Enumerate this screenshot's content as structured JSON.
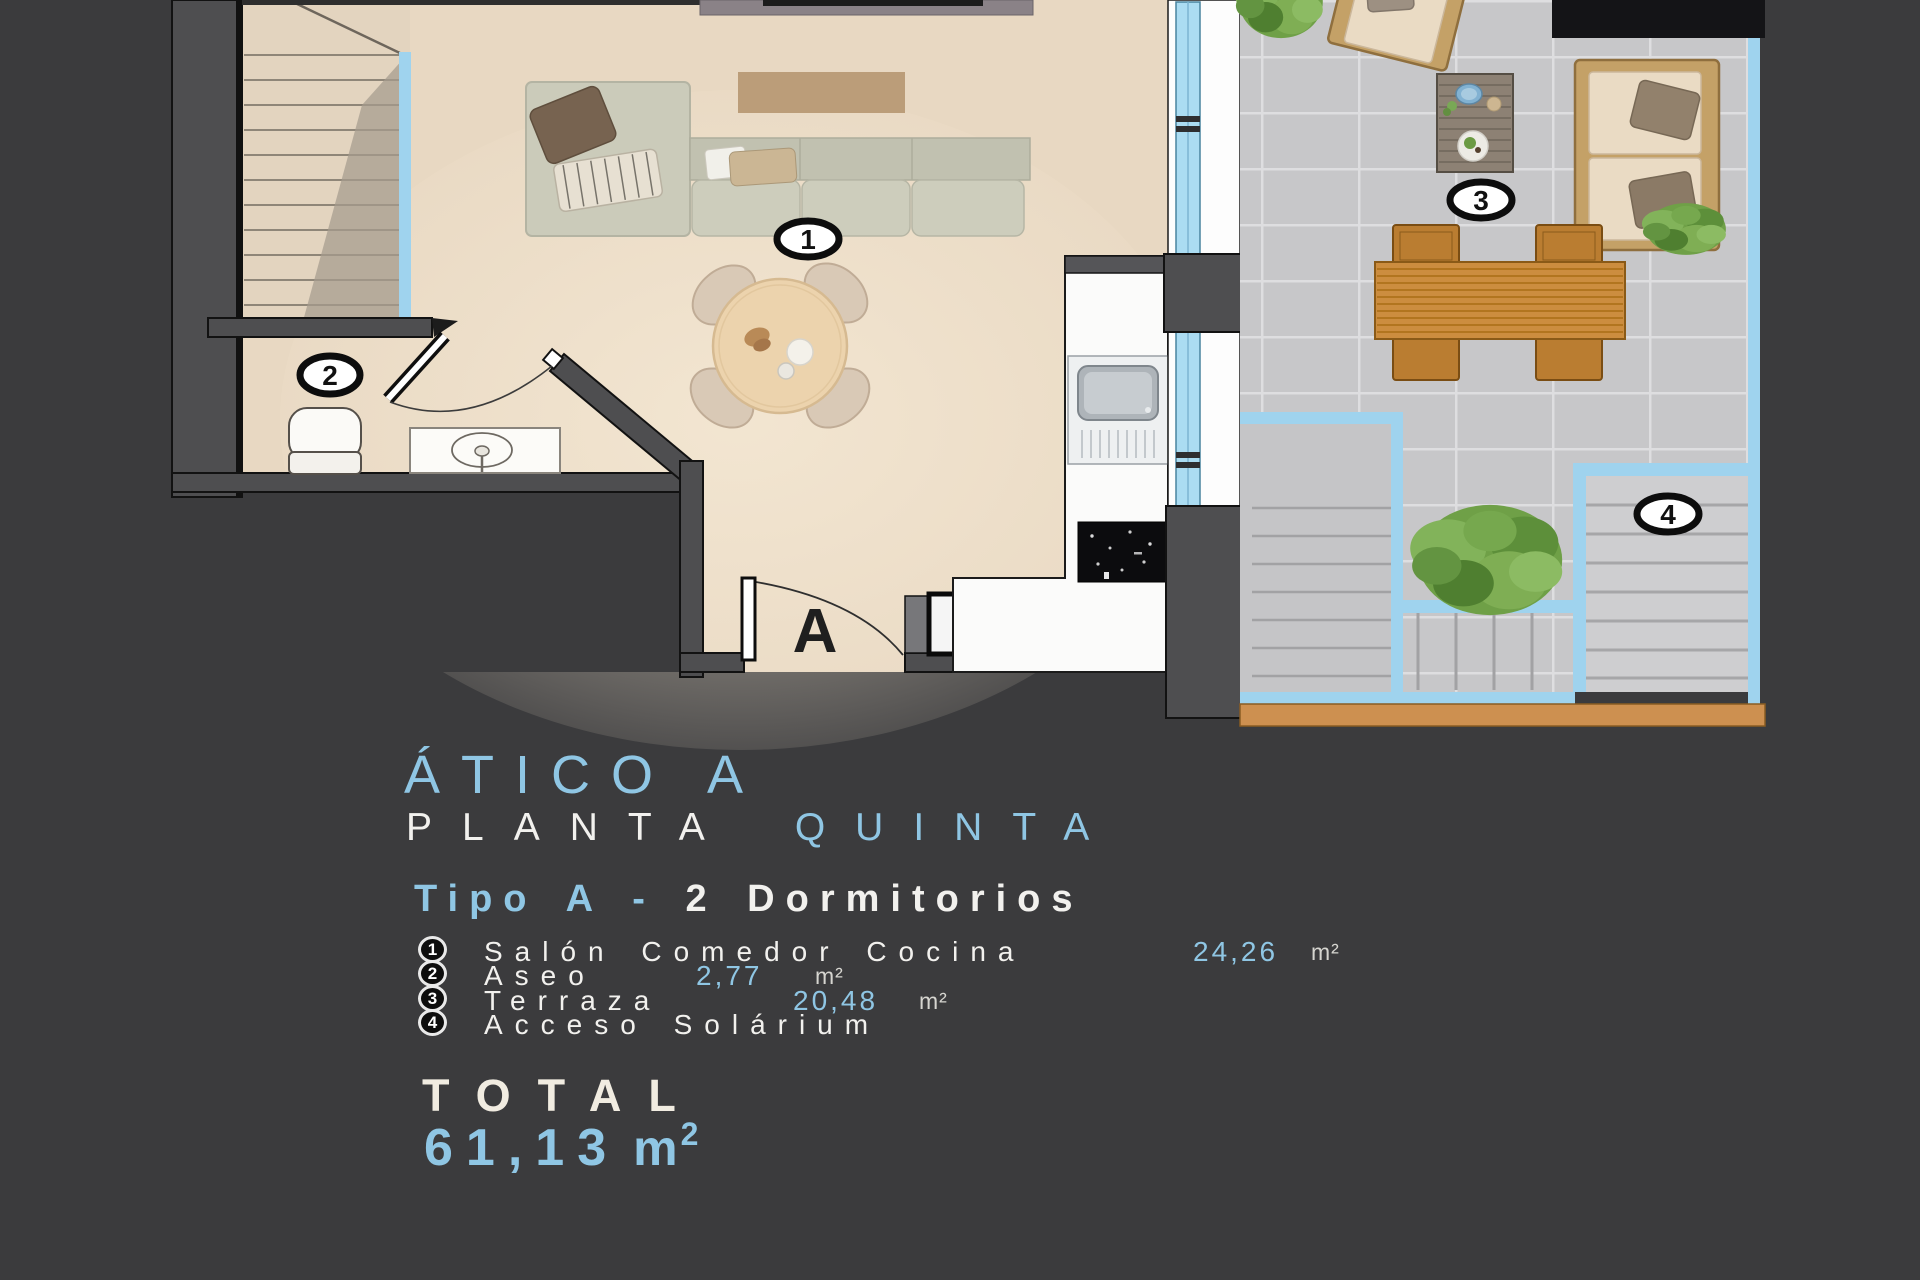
{
  "plan": {
    "door_label": "A",
    "markers": [
      {
        "num": "1",
        "meaning": "Salón Comedor Cocina"
      },
      {
        "num": "2",
        "meaning": "Aseo"
      },
      {
        "num": "3",
        "meaning": "Terraza"
      },
      {
        "num": "4",
        "meaning": "Acceso Solárium"
      }
    ]
  },
  "title": {
    "line1": "ÁTICO A",
    "line2_white": "PLANTA",
    "line2_blue": "QUINTA"
  },
  "subtitle": {
    "blue": "Tipo A -",
    "white": "2 Dormitorios"
  },
  "legend": {
    "items": [
      {
        "num": "1",
        "label": "Salón Comedor Cocina",
        "area": "24,26",
        "unit": "m²"
      },
      {
        "num": "2",
        "label": "Aseo",
        "area": "2,77",
        "unit": "m²"
      },
      {
        "num": "3",
        "label": "Terraza",
        "area": "20,48",
        "unit": "m²"
      },
      {
        "num": "4",
        "label": "Acceso Solárium",
        "area": "",
        "unit": ""
      }
    ]
  },
  "total": {
    "label": "TOTAL",
    "value": "61,13",
    "unit_base": "m",
    "unit_exp": "2"
  },
  "colors": {
    "background": "#3b3b3d",
    "accent_blue": "#8fc6e4",
    "plan_line_blue": "#9fd3ee",
    "floor_beige": "#e8d8c2",
    "terrace_tile": "#c7c7c9",
    "wall_gray": "#4e4e50",
    "wood": "#cd9050"
  }
}
